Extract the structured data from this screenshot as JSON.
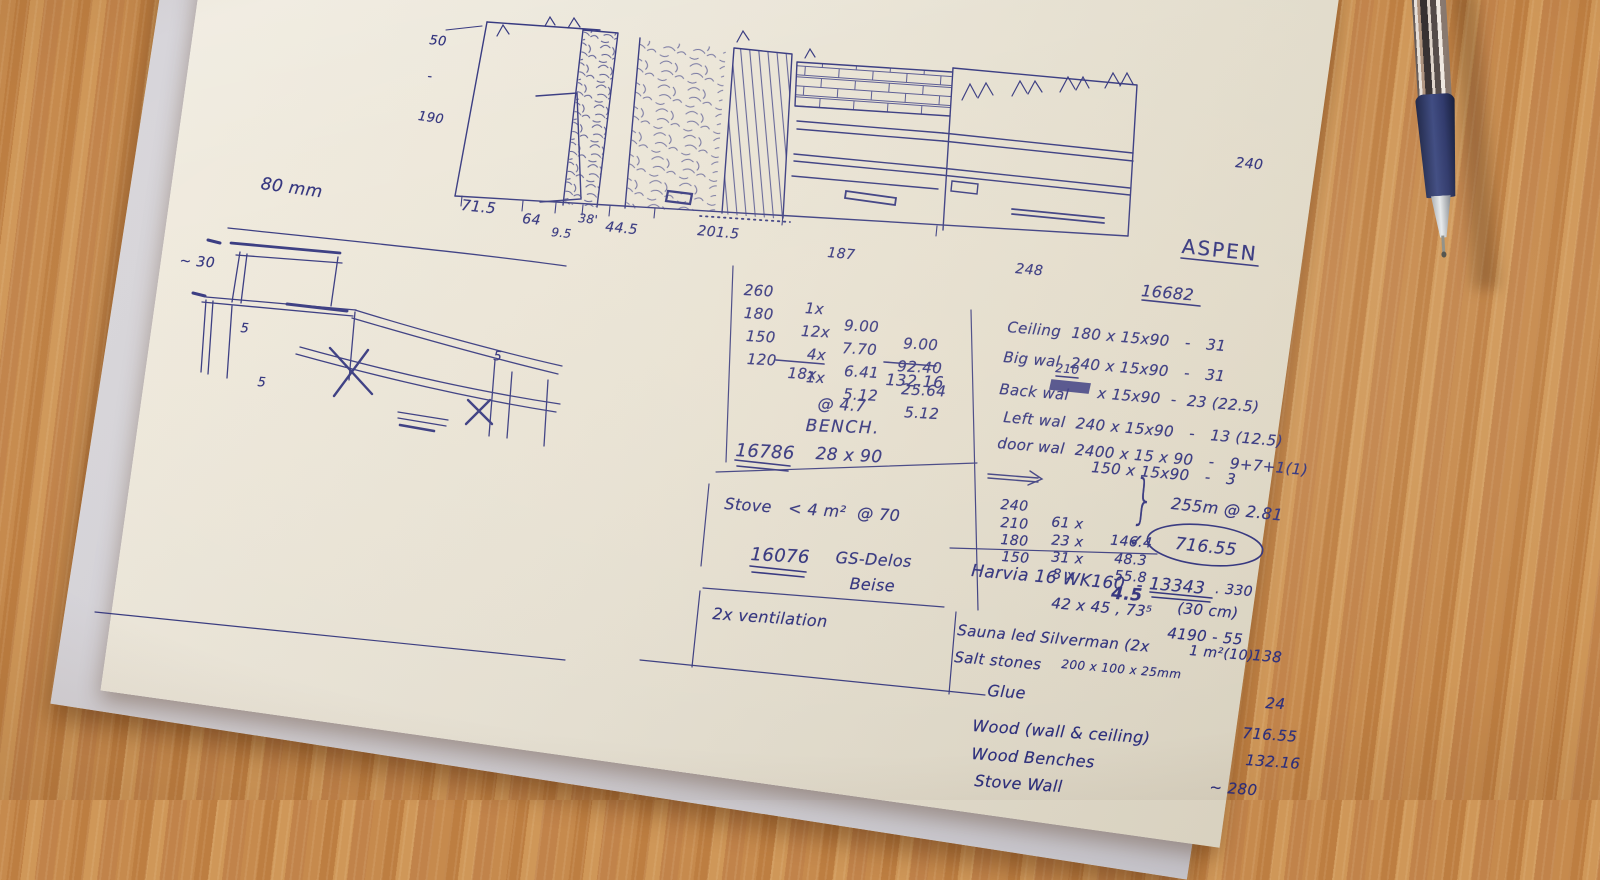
{
  "palette": {
    "ink": "#2d2f7c",
    "paper": "#e9e4d8",
    "wood": "#c3874a",
    "pen_grip": "#2b3569"
  },
  "elevation": {
    "left_dims": [
      "50",
      "-",
      "190"
    ],
    "dim_80": "80 mm",
    "bottom_dims": [
      "71.5",
      "64",
      "9.5",
      "38'",
      "44.5",
      "201.5"
    ],
    "dim_187": "187",
    "dim_248": "248",
    "dim_240": "240"
  },
  "bench_sketch": {
    "approx": "~ 30",
    "fives": [
      "5",
      "5",
      "5"
    ]
  },
  "calc": {
    "rows": [
      [
        "260",
        "1x",
        "9.00",
        "9.00"
      ],
      [
        "180",
        "12x",
        "7.70",
        "92.40"
      ],
      [
        "150",
        "4x",
        "6.41",
        "25.64"
      ],
      [
        "120",
        "1x",
        "5.12",
        "5.12"
      ]
    ],
    "sum_qty": "18x",
    "sum_total": "132.16",
    "rate": "@ 4.7",
    "bench_label": "BENCH.",
    "bench_total": "16786",
    "bench_size": "28 x 90"
  },
  "stove": {
    "line": "Stove   < 4 m²  @ 70",
    "price": "16076",
    "model": "GS-Delos",
    "finish": "Beise"
  },
  "ventilation": {
    "line": "2x ventilation"
  },
  "right": {
    "title": "ASPEN",
    "total": "16682",
    "wall_rows": [
      "Ceiling  180 x 15x90   -   31",
      "Big wal  240 x 15x90   -   31"
    ],
    "back_label": "Back wal",
    "back_corr": "210",
    "back_rest": "x 15x90  -  23 (22.5)",
    "wall_rows2": [
      "Left wal  240 x 15x90   -   13 (12.5)",
      "door wal  2400 x 15 x 90   -   9+7+1(1)",
      "150 x 15x90   -   3"
    ],
    "tally": [
      [
        "240",
        "61 x",
        "146.4"
      ],
      [
        "210",
        "23 x",
        "48.3"
      ],
      [
        "180",
        "31 x",
        "55.8"
      ],
      [
        "150",
        "8 x",
        "4.5"
      ]
    ],
    "tally_rate": "255m @ 2.81",
    "tally_total": "716.55",
    "check": "✓",
    "brace": "}",
    "items": [
      {
        "name": "Harvia 16 WK160  -",
        "price": "13343",
        "suffix": ". 330"
      },
      {
        "name": "42 x 45 , 73⁵",
        "note": "(30 cm)"
      },
      {
        "name": "Sauna led Silverman (2x",
        "price": "4190 - 55"
      },
      {
        "name": "Salt stones",
        "size": "200 x 100 x 25mm",
        "area": "1 m²(10)",
        "price": "138"
      },
      {
        "name": "Glue",
        "price": "24"
      },
      {
        "name": "Wood (wall & ceiling)",
        "price": "716.55"
      },
      {
        "name": "Wood Benches",
        "price": "132.16"
      },
      {
        "name": "Stove Wall",
        "price": "~ 280"
      }
    ]
  }
}
